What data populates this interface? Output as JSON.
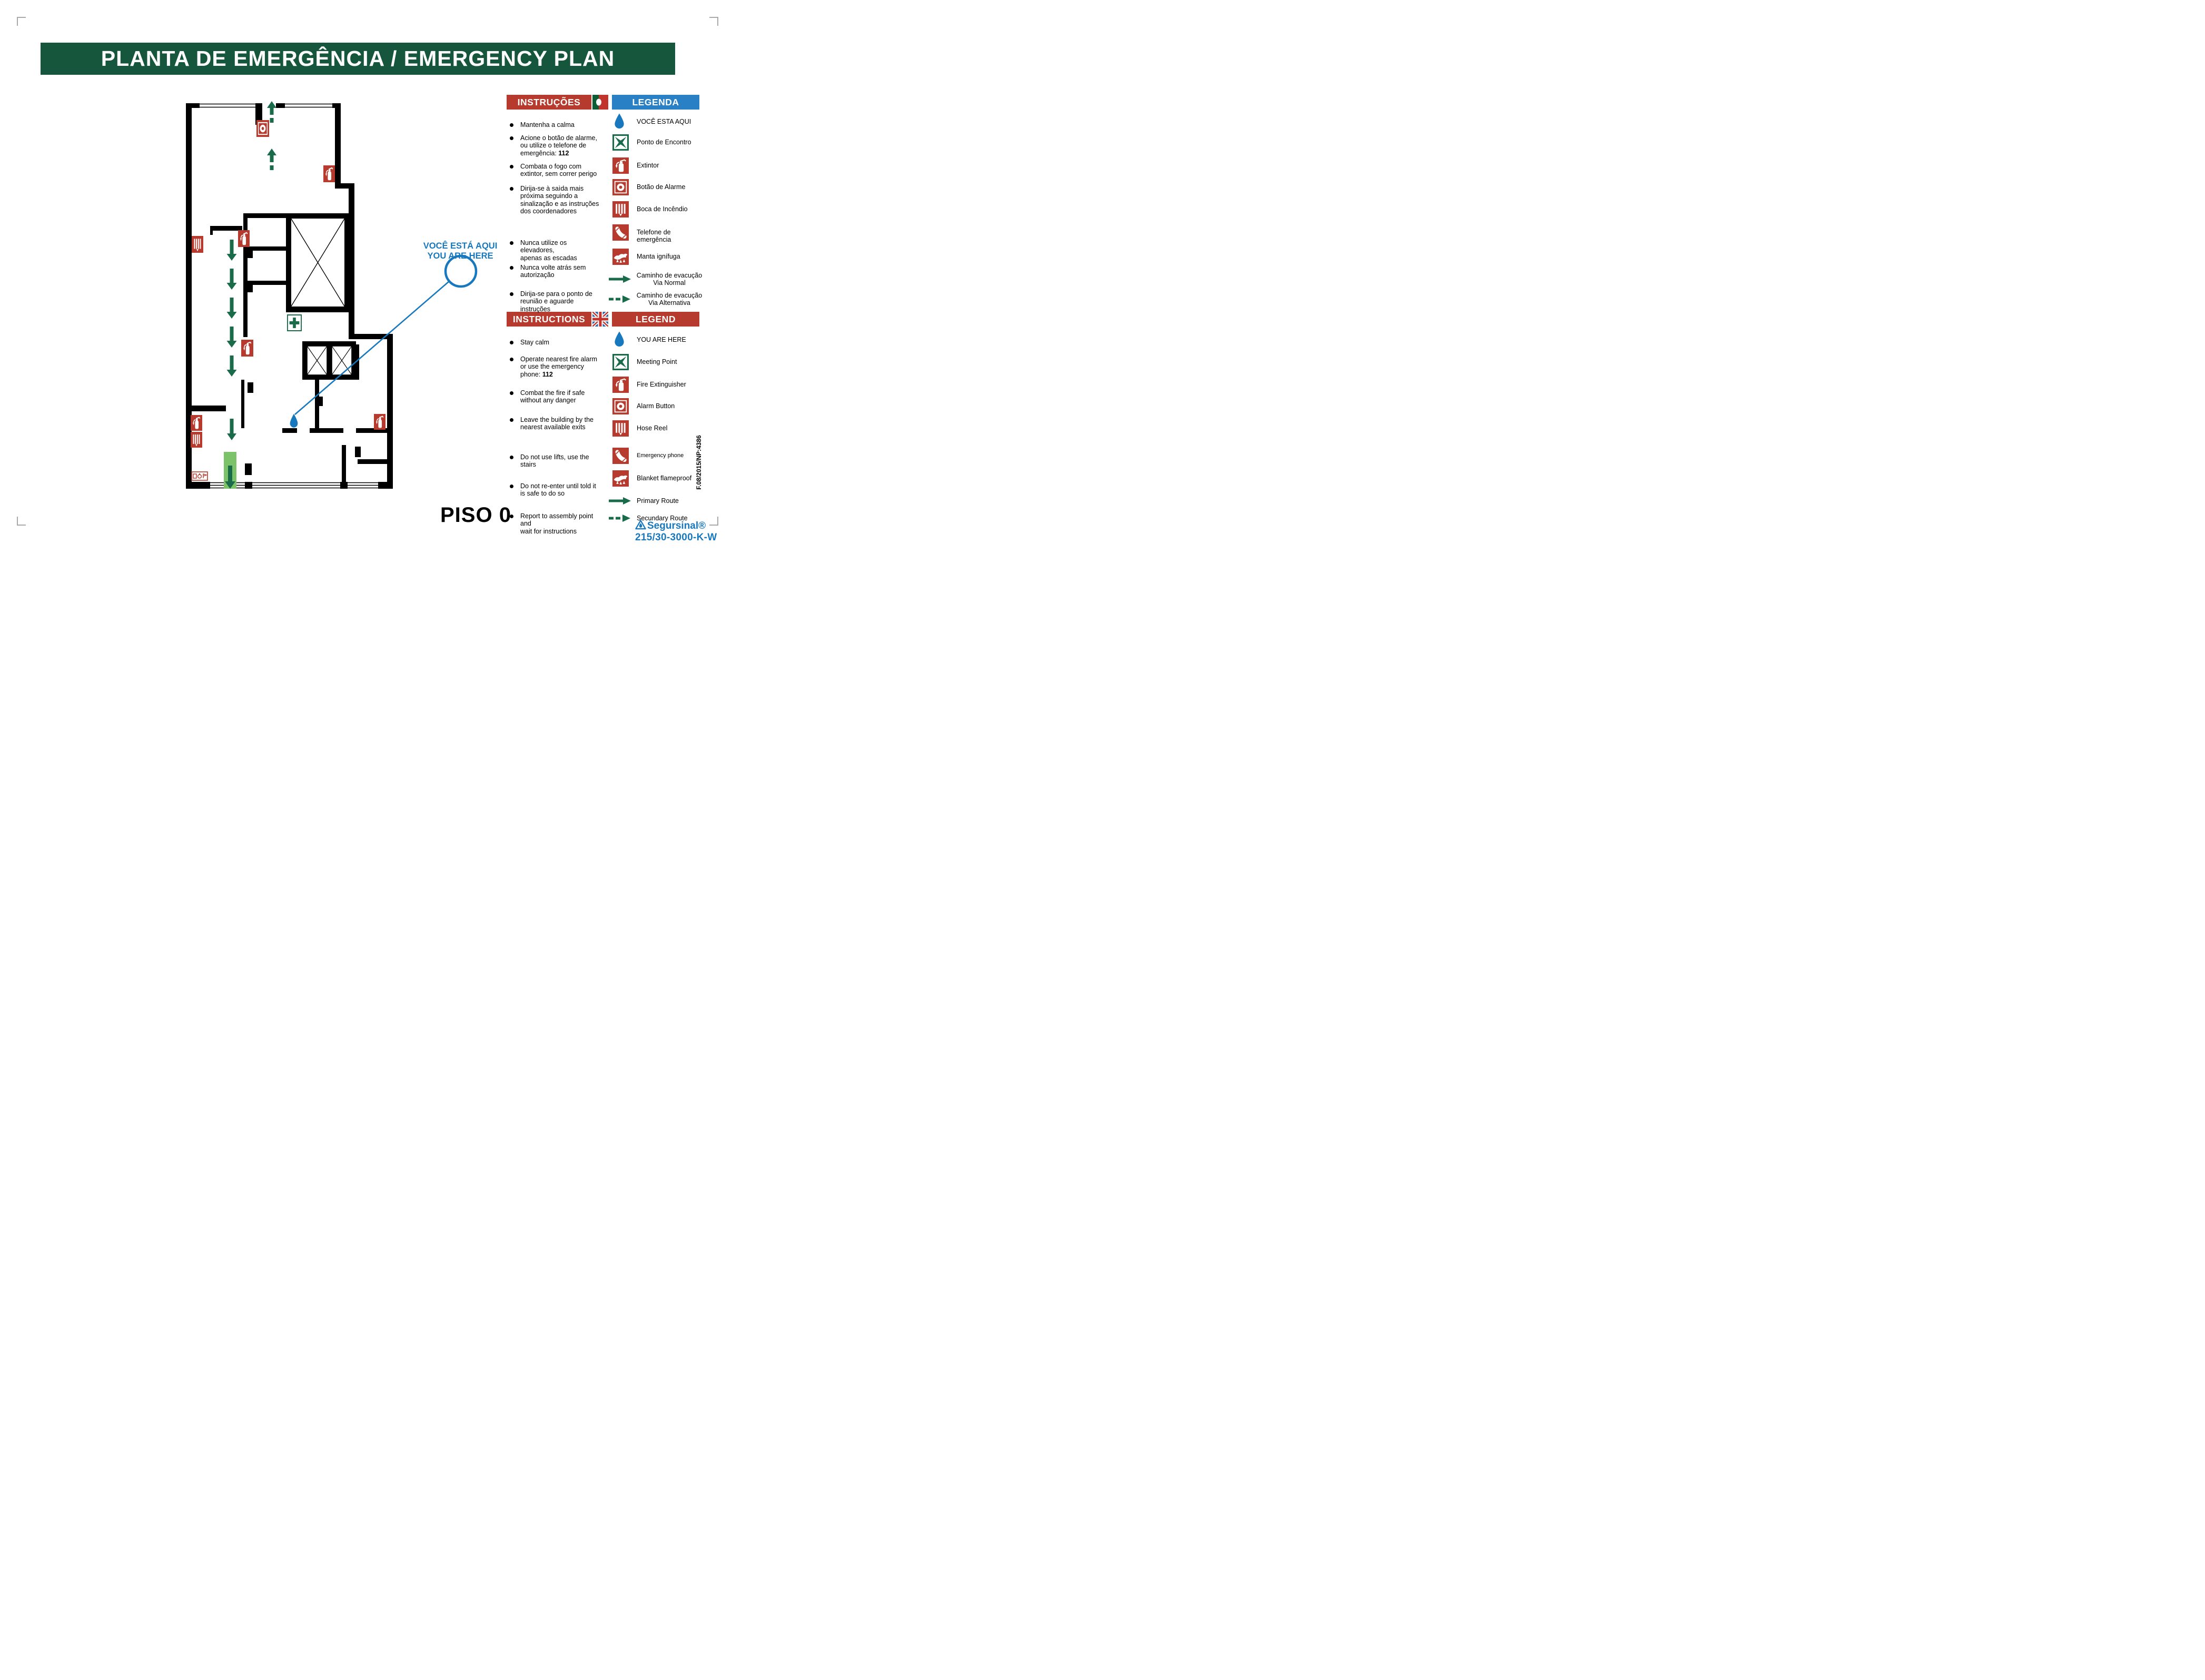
{
  "title": "PLANTA DE EMERGÊNCIA / EMERGENCY PLAN",
  "colors": {
    "banner_green": "#15563c",
    "safety_red": "#b63b2e",
    "legend_blue_header": "#2a80c4",
    "route_green": "#1a6b4a",
    "exit_light_green": "#7cc268",
    "you_are_here_blue": "#1878be"
  },
  "pt": {
    "instructions_header": "INSTRUÇÕES",
    "legend_header": "LEGENDA",
    "flag": "portugal-flag-icon",
    "instructions": [
      {
        "lines": [
          "Mantenha a calma"
        ]
      },
      {
        "lines": [
          "Acione o botão de alarme,",
          "ou utilize o telefone de",
          "emergência: **112**"
        ]
      },
      {
        "lines": [
          "Combata o fogo com",
          "extintor, sem correr perigo"
        ]
      },
      {
        "lines": [
          "Dirija-se à saìda mais",
          "próxima seguindo a",
          "sinalização e as instruções",
          "dos coordenadores"
        ]
      },
      {
        "lines": [
          "Nunca utilize os elevadores,",
          "apenas as escadas"
        ]
      },
      {
        "lines": [
          "Nunca volte atrás sem",
          "autorização"
        ]
      },
      {
        "lines": [
          "Dirija-se para o ponto de",
          "reunião e aguarde instruções"
        ]
      }
    ],
    "legend": [
      {
        "icon": "you-are-here-droplet-icon",
        "label": "VOCÊ ESTA AQUI"
      },
      {
        "icon": "meeting-point-icon",
        "label": "Ponto de Encontro"
      },
      {
        "icon": "fire-extinguisher-icon",
        "label": "Extintor"
      },
      {
        "icon": "alarm-button-icon",
        "label": "Botão de Alarme"
      },
      {
        "icon": "hose-reel-icon",
        "label": "Boca de Incêndio"
      },
      {
        "icon": "emergency-phone-icon",
        "label": "Telefone de emergência"
      },
      {
        "icon": "fire-blanket-icon",
        "label": "Manta ignífuga"
      },
      {
        "icon": "primary-route-arrow-icon",
        "label": "Caminho de evacução",
        "label2": "Via Normal"
      },
      {
        "icon": "secondary-route-arrow-icon",
        "label": "Caminho de evacução",
        "label2": "Via Alternativa"
      }
    ]
  },
  "en": {
    "instructions_header": "INSTRUCTIONS",
    "legend_header": "LEGEND",
    "flag": "united-kingdom-flag-icon",
    "instructions": [
      {
        "lines": [
          "Stay calm"
        ]
      },
      {
        "lines": [
          "Operate nearest fire alarm",
          "or use the emergency",
          "phone: **112**"
        ]
      },
      {
        "lines": [
          "Combat the fire if safe",
          "without any danger"
        ]
      },
      {
        "lines": [
          "Leave the building by the",
          "nearest available exits"
        ]
      },
      {
        "lines": [
          "Do not use lifts, use the",
          "stairs"
        ]
      },
      {
        "lines": [
          "Do not re-enter until told it",
          "is safe to do so"
        ]
      },
      {
        "lines": [
          "Report to assembly point and",
          "wait for instructions"
        ]
      }
    ],
    "legend": [
      {
        "icon": "you-are-here-droplet-icon",
        "label": "YOU ARE HERE"
      },
      {
        "icon": "meeting-point-icon",
        "label": "Meeting Point"
      },
      {
        "icon": "fire-extinguisher-icon",
        "label": "Fire Extinguisher"
      },
      {
        "icon": "alarm-button-icon",
        "label": "Alarm Button"
      },
      {
        "icon": "hose-reel-icon",
        "label": "Hose Reel"
      },
      {
        "icon": "emergency-phone-icon",
        "label": "Emergency phone",
        "small": true
      },
      {
        "icon": "fire-blanket-icon",
        "label": "Blanket flameproof"
      },
      {
        "icon": "primary-route-arrow-icon",
        "label": "Primary Route"
      },
      {
        "icon": "secondary-route-arrow-icon",
        "label": "Secundary Route"
      }
    ]
  },
  "plan": {
    "floor_label": "PISO 0",
    "you_are_here_callout_pt": "VOCÊ ESTÁ AQUI",
    "you_are_here_callout_en": "YOU ARE HERE",
    "icon_counts": {
      "fire-extinguisher": 5,
      "hose-reel": 2,
      "alarm-button": 1,
      "first-aid-cross": 1,
      "fire-equipment-sign": 1,
      "you-are-here-droplet": 1,
      "evacuation-down-arrows": 7,
      "evacuation-up-arrows": 2
    }
  },
  "footer": {
    "brand": "Segursinal®",
    "model": "215/30-3000-K-W",
    "reference_code": "F.08/2015/NP:4386"
  }
}
